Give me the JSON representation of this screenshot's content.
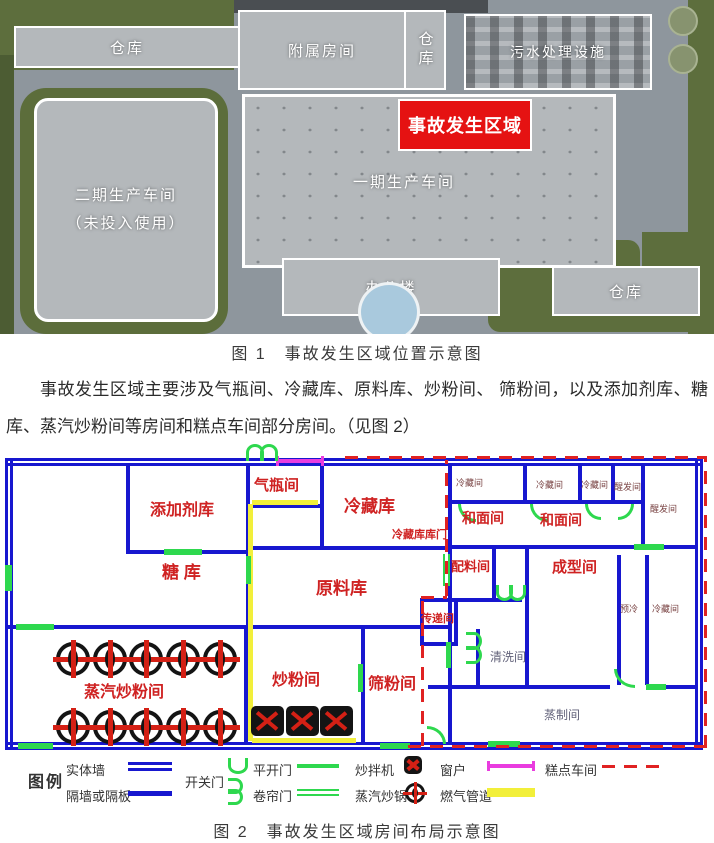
{
  "figure1": {
    "caption": "图 1　事故发生区域位置示意图",
    "labels": {
      "warehouse_top_left": "仓库",
      "annex_rooms": "附属房间",
      "warehouse_top_vertical": "仓库",
      "sewage_plant": "污水处理设施",
      "phase2_line1": "二期生产车间",
      "phase2_line2": "（未投入使用）",
      "phase1_workshop": "一期生产车间",
      "accident_area": "事故发生区域",
      "office_building": "办公楼",
      "warehouse_bottom_right": "仓库"
    }
  },
  "paragraph": {
    "text": "事故发生区域主要涉及气瓶间、冷藏库、原料库、炒粉间、 筛粉间，以及添加剂库、糖库、蒸汽炒粉间等房间和糕点车间部分房间。（见图 2）"
  },
  "figure2": {
    "caption": "图 2　事故发生区域房间布局示意图",
    "rooms": {
      "sugar_store": "糖 库",
      "additive_store": "添加剂库",
      "gas_cylinder_room": "气瓶间",
      "cold_storage": "冷藏库",
      "cold_storage_door": "冷藏库库门",
      "raw_material_store": "原料库",
      "transfer_room": "传递间",
      "batching_room": "配料间",
      "steam_fry_room": "蒸汽炒粉间",
      "fry_room": "炒粉间",
      "sieve_room": "筛粉间",
      "mixing_room_1": "和面间",
      "mixing_room_2": "和面间",
      "forming_room": "成型间",
      "cleaning_room": "清洗间",
      "steaming_room": "蒸制间",
      "precool_room": "预冷",
      "cold_room_1": "冷藏间",
      "cold_room_2": "冷藏间",
      "cold_room_3": "冷藏间",
      "cold_room_right": "冷藏间",
      "proofing_room_1": "醒发间",
      "proofing_room_2": "醒发间"
    },
    "legend": {
      "title": "图例",
      "solid_wall": "实体墙",
      "partition": "隔墙或隔板",
      "swing_door": "开关门",
      "casement_door": "平开门",
      "roller_door": "卷帘门",
      "fry_mixer": "炒拌机",
      "steam_wok": "蒸汽炒锅",
      "window": "窗户",
      "gas_pipeline": "燃气管道",
      "pastry_workshop": "糕点车间"
    },
    "colors": {
      "wall": "#1717cf",
      "door": "#2ed84e",
      "window": "#e93cdf",
      "gas": "#f2ef3a",
      "boundary": "#e02222",
      "room_label": "#cf2222",
      "accident_red": "#e51212"
    }
  }
}
